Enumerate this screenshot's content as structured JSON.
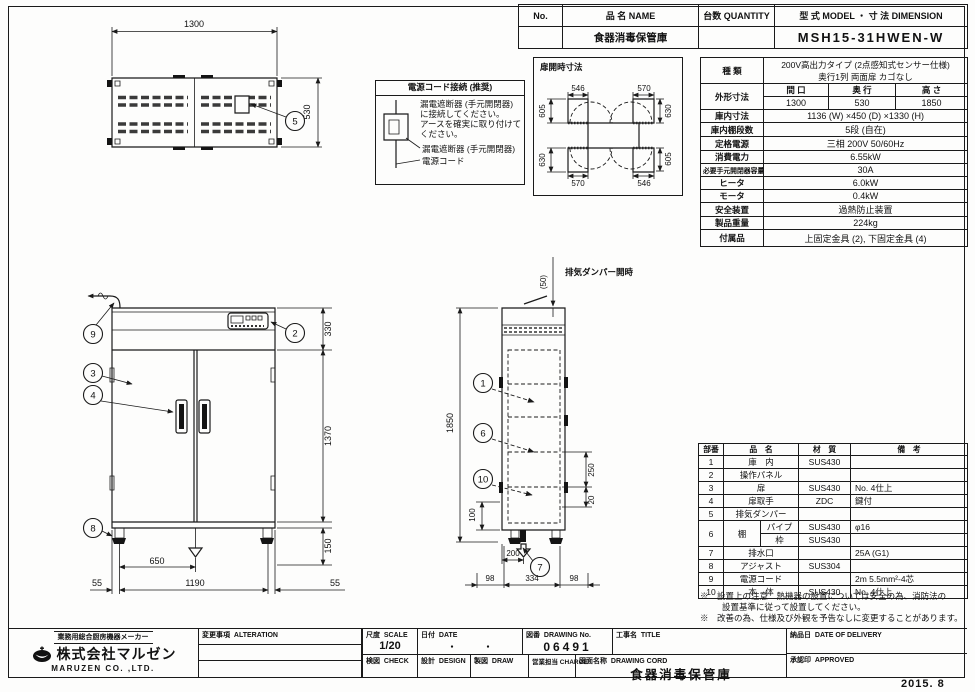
{
  "header_table": {
    "col_no": "No.",
    "col_name": "品  名 NAME",
    "col_qty": "台数 QUANTITY",
    "col_model": "型  式 MODEL   ・   寸  法 DIMENSION",
    "name_value": "食器消毒保管庫",
    "qty_value": "",
    "model_value": "MSH15-31HWEN-W"
  },
  "spec_table": {
    "kind_label": "種  類",
    "kind_line1": "200V高出力タイプ (2点感知式センサー仕様)",
    "kind_line2": "奥行1列 両面扉 カゴなし",
    "outer_label": "外形寸法",
    "outer_cols": [
      "間  口",
      "奥  行",
      "高  さ"
    ],
    "outer_vals": [
      "1300",
      "530",
      "1850"
    ],
    "rows": [
      {
        "label": "庫内寸法",
        "value": "1136 (W) ×450 (D) ×1330 (H)"
      },
      {
        "label": "庫内棚段数",
        "value": "5段 (自在)"
      },
      {
        "label": "定格電源",
        "value": "三相 200V 50/60Hz"
      },
      {
        "label": "消費電力",
        "value": "6.55kW"
      },
      {
        "label": "必要手元開閉器容量",
        "value": "30A"
      },
      {
        "label": "ヒータ",
        "value": "6.0kW"
      },
      {
        "label": "モータ",
        "value": "0.4kW"
      },
      {
        "label": "安全装置",
        "value": "過熱防止装置"
      },
      {
        "label": "製品重量",
        "value": "224kg"
      }
    ],
    "accessory_label": "付属品",
    "accessory_value": "上固定金具 (2), 下固定金具 (4)"
  },
  "door_open": {
    "title": "扉開時寸法",
    "dim_top_left": "546",
    "dim_top_right": "570",
    "dim_left_top": "605",
    "dim_right_top": "630",
    "dim_left_bottom": "630",
    "dim_right_bottom": "605",
    "dim_bottom_left": "570",
    "dim_bottom_right": "546"
  },
  "power_note": {
    "title": "電源コード接続 (推奨)",
    "line1": "漏電遮断器 (手元開閉器)",
    "line2": "に接続してください。",
    "line3": "アースを確実に取り付けて",
    "line4": "ください。",
    "label_breaker": "漏電遮断器 (手元開閉器)",
    "label_cord": "電源コード"
  },
  "plan_view": {
    "dim_width": "1300",
    "dim_depth": "530",
    "balloon_damper": "5"
  },
  "front_view": {
    "dim_top": "330",
    "dim_door": "1370",
    "dim_leg": "150",
    "dim_center": "650",
    "dim_width": "1190",
    "dim_left": "55",
    "dim_right": "55",
    "balloon_cord": "9",
    "balloon_panel": "2",
    "balloon_door": "3",
    "balloon_handle": "4",
    "balloon_adjuster": "8"
  },
  "side_view": {
    "damper_label": "排気ダンパー開時",
    "dim_damper": "(50)",
    "dim_height": "1850",
    "dim_pitch": "250",
    "dim_gap": "20",
    "dim_bottom": "100",
    "dim_drain": "200",
    "dim_depth": "334",
    "dim_front": "98",
    "dim_back": "98",
    "balloon_interior": "1",
    "balloon_shelf": "6",
    "balloon_body": "10",
    "balloon_drain": "7"
  },
  "parts_table": {
    "headers": [
      "部番",
      "品　名",
      "材　質",
      "備　考"
    ],
    "rows": [
      {
        "no": "1",
        "name": "庫　内",
        "mat": "SUS430",
        "note": ""
      },
      {
        "no": "2",
        "name": "操作パネル",
        "mat": "",
        "note": ""
      },
      {
        "no": "3",
        "name": "扉",
        "mat": "SUS430",
        "note": "No. 4仕上"
      },
      {
        "no": "4",
        "name": "扉取手",
        "mat": "ZDC",
        "note": "鍵付"
      },
      {
        "no": "5",
        "name": "排気ダンパー",
        "mat": "",
        "note": ""
      },
      {
        "no": "6",
        "name": "棚",
        "sub_pipe": "パイプ",
        "pipe_mat": "SUS430",
        "pipe_note": "φ16",
        "sub_frame": "枠",
        "frame_mat": "SUS430",
        "frame_note": ""
      },
      {
        "no": "7",
        "name": "排水口",
        "mat": "",
        "note": "25A (G1)"
      },
      {
        "no": "8",
        "name": "アジャスト",
        "mat": "SUS304",
        "note": ""
      },
      {
        "no": "9",
        "name": "電源コード",
        "mat": "",
        "note": "2m 5.5mm²-4芯"
      },
      {
        "no": "10",
        "name": "本　体",
        "mat": "SUS430",
        "note": "No. 4仕上"
      }
    ],
    "note1": "※　設置上の注意　熱機器の設置については安全の為、消防法の",
    "note2": "設置基準に従って設置してください。",
    "note3": "※　改善の為、仕様及び外観を予告なしに変更することがあります。"
  },
  "title_block": {
    "maker_tagline": "業務用総合厨房機器メーカー",
    "company": "株式会社マルゼン",
    "company_en": "MARUZEN  CO. ,LTD.",
    "alteration_label": "変更事項  ALTERATION",
    "scale_label": "尺度  SCALE",
    "scale_value": "1/20",
    "date_label": "日付  DATE",
    "date_value": "・　　　・",
    "drawing_no_label": "図番  DRAWING No.",
    "drawing_no_value": "06491",
    "title_label": "工事名  TITLE",
    "check_label": "検図  CHECK",
    "design_label": "設計  DESIGN",
    "draw_label": "製図  DRAW",
    "charge_label": "営業担当 CHARGE",
    "drawing_name_label": "図面名称  DRAWING CORD",
    "drawing_name_value": "食器消毒保管庫",
    "delivery_label": "納品日  DATE OF DELIVERY",
    "approved_label": "承認印  APPROVED",
    "date_stamp": "2015. 8"
  }
}
